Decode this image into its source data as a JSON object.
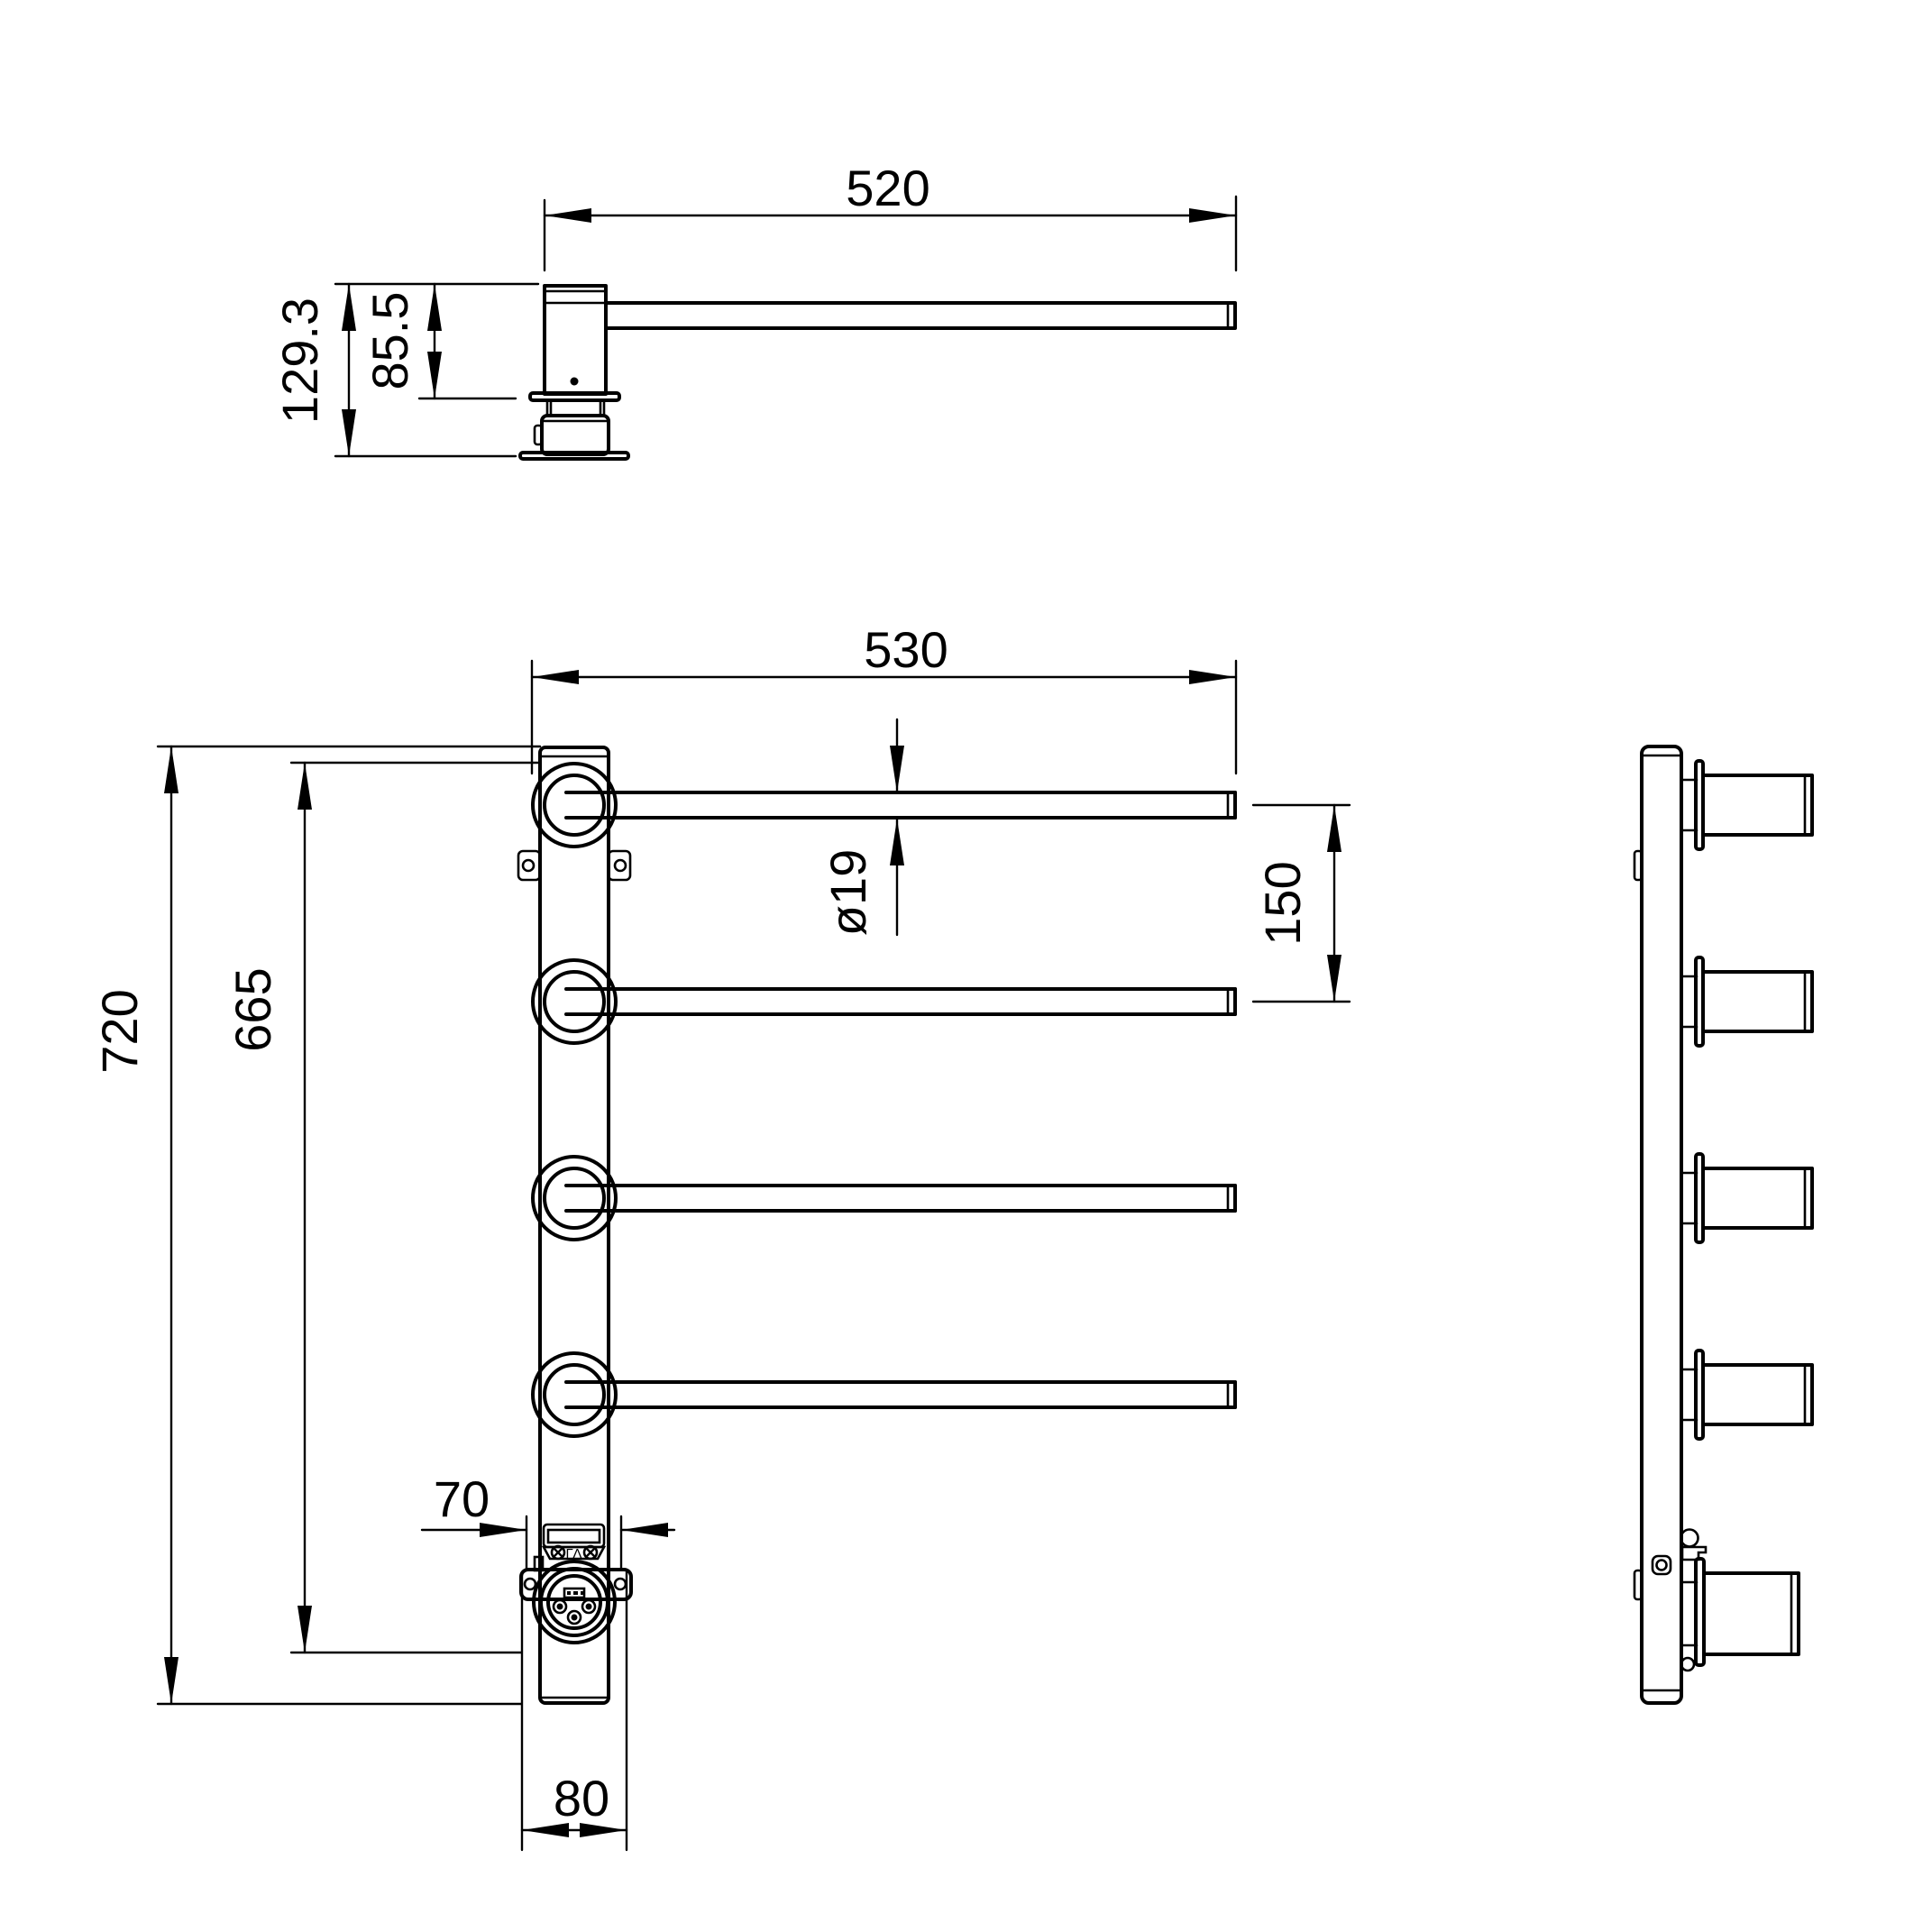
{
  "drawing": {
    "type": "technical-dimension-drawing",
    "background": "#ffffff",
    "line_color": "#000000",
    "views": {
      "top": {
        "label": "arm-side-profile-view",
        "dimensions": {
          "arm_length": "520",
          "total_height": "129.3",
          "upper_height": "85.5"
        }
      },
      "front": {
        "label": "front-view",
        "dimensions": {
          "bar_length": "530",
          "total_height": "720",
          "socket_height": "665",
          "bar_spacing": "150",
          "bar_diameter": "ø19",
          "junction_width": "70",
          "base_width": "80"
        }
      },
      "side": {
        "label": "side-view"
      }
    },
    "marks": {
      "junction_box": "ΓΛ"
    }
  }
}
